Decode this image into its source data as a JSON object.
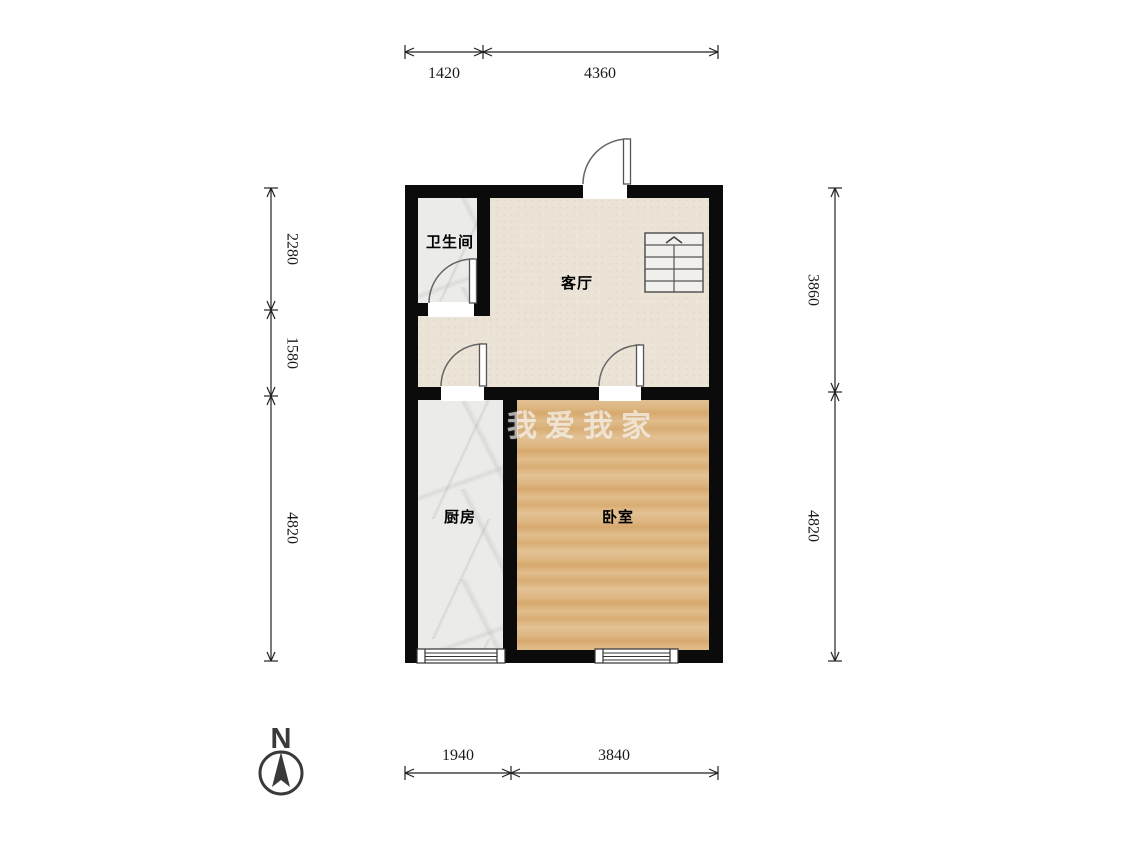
{
  "title": "户型图",
  "colors": {
    "wall": "#0b0b0b",
    "living-floor": "#eae3d6",
    "tile-floor": "#ebebea",
    "wood-floor": "#dcb27e",
    "dim-text": "#1a1a1a",
    "compass": "#3a3a3a"
  },
  "rooms": {
    "bathroom": {
      "label": "卫生间"
    },
    "living": {
      "label": "客厅"
    },
    "kitchen": {
      "label": "厨房"
    },
    "bedroom": {
      "label": "卧室"
    }
  },
  "dimensions": {
    "top": [
      "1420",
      "4360"
    ],
    "bottom": [
      "1940",
      "3840"
    ],
    "left": [
      "2280",
      "1580",
      "4820"
    ],
    "right": [
      "3860",
      "4820"
    ]
  },
  "compass": {
    "north_label": "N"
  },
  "watermark": {
    "text": "我爱我家"
  },
  "stairs": {
    "direction": "up"
  }
}
